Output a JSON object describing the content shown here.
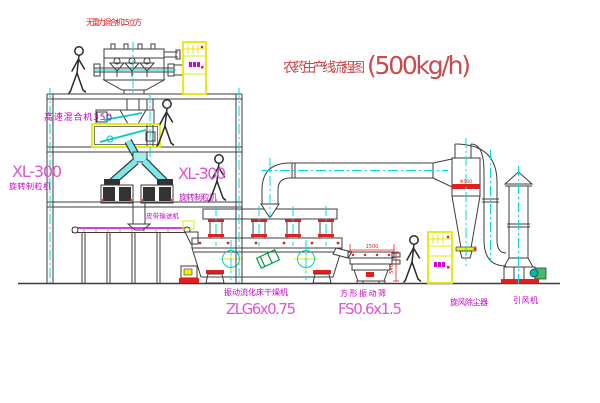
{
  "title": {
    "name": "农药生产线流程图",
    "capacity": "(500kg/h)"
  },
  "labels": {
    "gravity_mixer": "无重力混合机1.5 立方",
    "high_speed_mixer": "高速混合机350",
    "granulator_left_model": "XL-300",
    "granulator_left_name": "旋转制粒机",
    "granulator_right_model": "XL-300",
    "granulator_right_name": "旋转制粒机",
    "belt_conveyor": "皮带输送机",
    "dryer_name": "振动流化床干燥机",
    "dryer_model": "ZLG6x0.75",
    "screen_name": "方形振动筛",
    "screen_model": "FS0.6x1.5",
    "cyclone_name": "旋风除尘器",
    "fan_name": "引风机"
  },
  "dimensions": {
    "screen_length": "1500",
    "screen_height": "540",
    "cyclone_marking": "Φ500"
  },
  "colors": {
    "centerline_cyan": "#00dcdc",
    "label_magenta": "#c800c8",
    "model_magenta": "#d957d9",
    "title_red": "#cc4a4a",
    "accent_red": "#e02020",
    "cabinet_yellow": "#e8e800",
    "machine_line": "#3c3c3c",
    "green_accent": "#009944"
  }
}
